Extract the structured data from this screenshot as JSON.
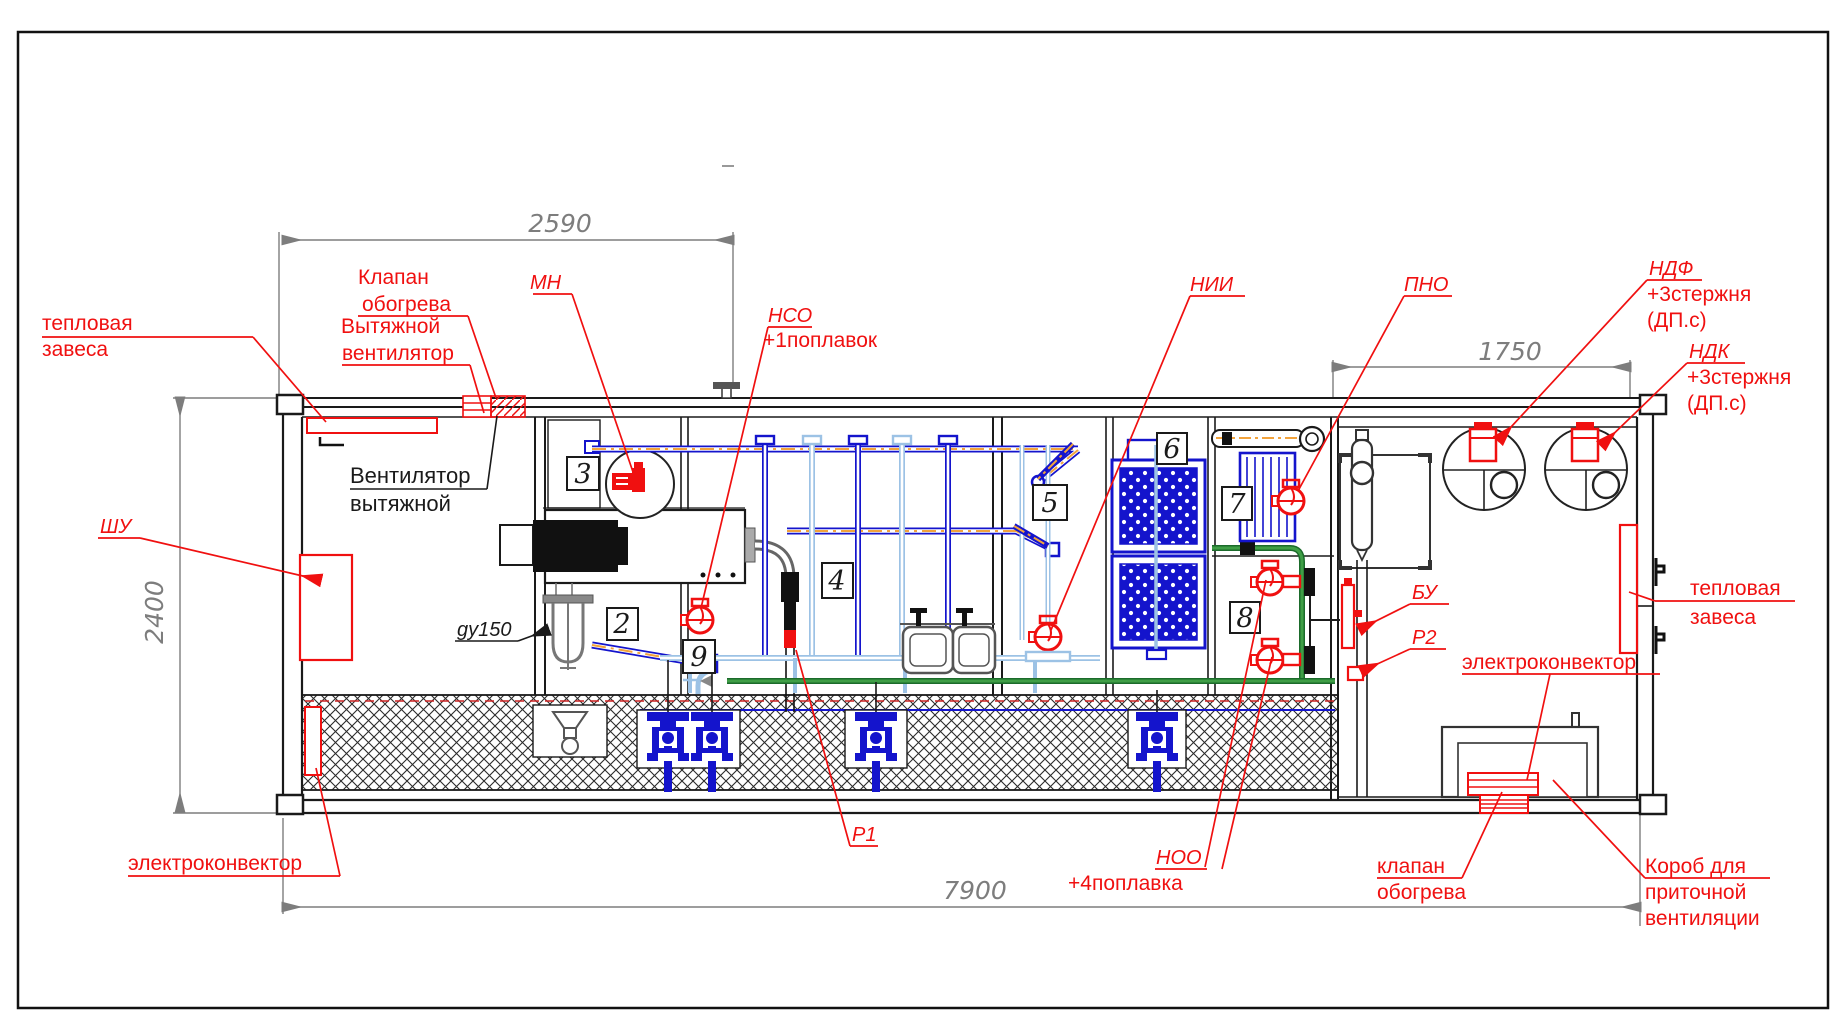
{
  "dims": {
    "d2590": "2590",
    "d1750": "1750",
    "d2400": "2400",
    "d7900": "7900"
  },
  "positions": {
    "p2": "2",
    "p3": "3",
    "p4": "4",
    "p5": "5",
    "p6": "6",
    "p7": "7",
    "p8": "8",
    "p9": "9"
  },
  "tags": {
    "mn": "МН",
    "nso": "НСО",
    "nso_note": "+1поплавок",
    "nii": "НИИ",
    "pno": "ПНО",
    "ndf": "НДФ",
    "ndk": "НДК",
    "rods": "+3стержня",
    "rods_sub": "(ДП.с)",
    "shu": "ШУ",
    "gy150": "gy150",
    "bu": "БУ",
    "r2": "Р2",
    "r1": "Р1",
    "noo": "НОО",
    "noo_note": "+4поплавка"
  },
  "labels": {
    "heat_curtain_1": "тепловая",
    "heat_curtain_2": "завеса",
    "heat_valve_1": "Клапан",
    "heat_valve_2": "обогрева",
    "exhaust_fan_red_1": "Вытяжной",
    "exhaust_fan_red_2": "вентилятор",
    "exhaust_fan_black_1": "Вентилятор",
    "exhaust_fan_black_2": "вытяжной",
    "electroconvector": "электроконвектор",
    "heat_valve_low_1": "клапан",
    "heat_valve_low_2": "обогрева",
    "duct_1": "Короб для",
    "duct_2": "приточной",
    "duct_3": "вентиляции"
  },
  "colors": {
    "annotation_red": "#f01010",
    "pipe_blue": "#1414cc",
    "pipe_light_blue": "#9cc2e5",
    "heat_trace_orange": "#f2a33c",
    "pipe_green": "#3f9e46",
    "dimension_gray": "#7d7d7d",
    "line_black": "#1a1a1a"
  }
}
